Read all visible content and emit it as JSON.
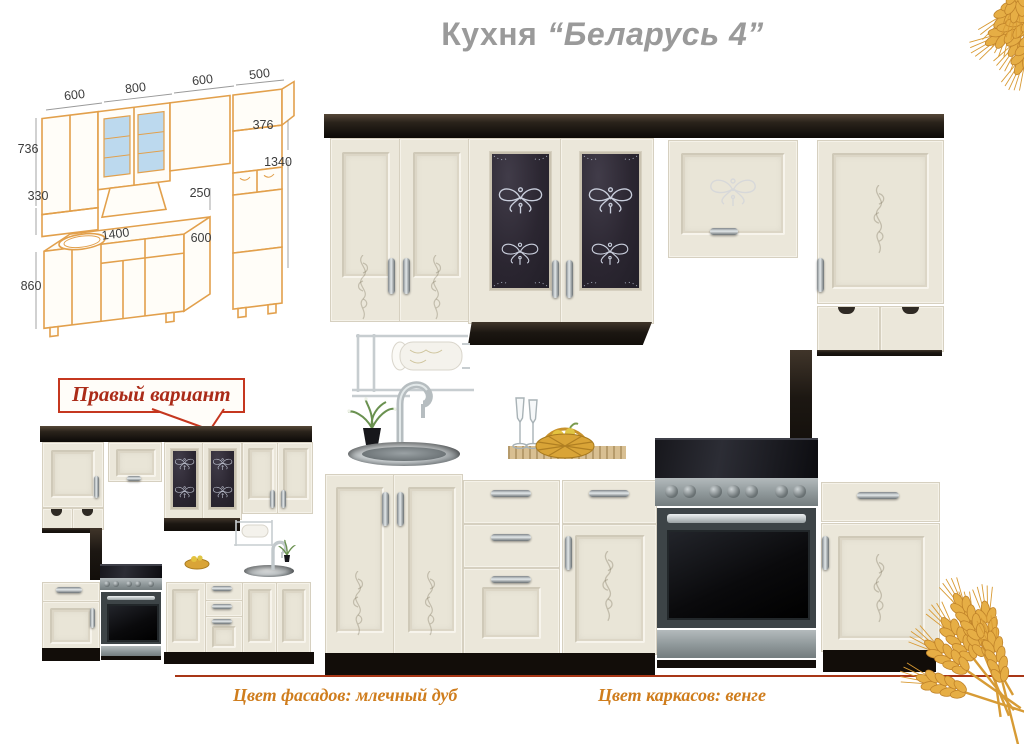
{
  "title": {
    "prefix": "Кухня",
    "model": "“Беларусь 4”"
  },
  "drawing": {
    "dims": {
      "w1": "600",
      "w2": "800",
      "w3": "600",
      "w4": "500",
      "h_wall": "736",
      "d_wall": "330",
      "h_upper_right": "376",
      "h_tall": "1340",
      "gap": "250",
      "w_base": "1400",
      "d_base": "600",
      "h_base": "860"
    }
  },
  "callout": {
    "label": "Правый вариант"
  },
  "captions": {
    "facades": "Цвет фасадов: млечный дуб",
    "frames": "Цвет каркасов: венге"
  },
  "colors": {
    "title_gray": "#9a9a9a",
    "drawing_orange": "#e2a04c",
    "drawing_glass_blue": "#bcd9ee",
    "callout_red": "#c5371f",
    "caption_orange": "#cf7d1d",
    "facade_cream": "#ebe7da",
    "carcass_wenge": "#1c1712",
    "countertop": "#3a3631",
    "wheat_gold": "#e6ae45"
  }
}
